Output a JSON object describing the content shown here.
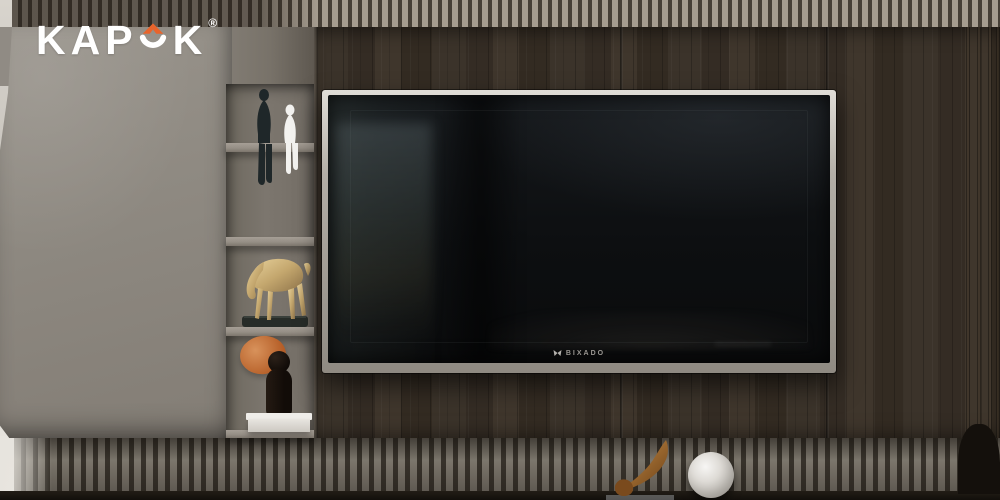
{
  "brand": {
    "full_name": "KAPOK",
    "name_prefix": "KAP",
    "name_suffix": "K",
    "registered_mark": "®",
    "accent_color": "#E8642C",
    "text_color": "#FFFFFF"
  },
  "tv": {
    "brand_label": "BIXADO",
    "logo_icon": "butterfly-icon",
    "frame_color": "#B9B4AC",
    "screen_color": "#0D0F11"
  },
  "palette": {
    "wood_dark": "#372F26",
    "cabinet_gray": "#8E8981",
    "niche_gray": "#76716A",
    "slat_light": "#A59C8F",
    "slat_gap": "#3E3931",
    "floor": "#16120E",
    "shelf_board": "#9E978E"
  },
  "decor": {
    "shelf_items": [
      {
        "name": "sitting-figurine-black",
        "color": "#1F2729"
      },
      {
        "name": "sitting-figurine-white",
        "color": "#F3F2EF"
      },
      {
        "name": "horse-sculpture-gold",
        "color": "#C4A76E",
        "base_color": "#272C28"
      },
      {
        "name": "bubble-figurine-black",
        "color": "#17110E",
        "bubble_color": "#B65F28",
        "base_color": "#EFEDE9"
      }
    ],
    "floor_items": [
      {
        "name": "bronze-abstract-sculpture",
        "color": "#9C6527"
      },
      {
        "name": "glass-sphere-lamp",
        "color": "#DEDBD6"
      },
      {
        "name": "dark-planter-silhouette",
        "color": "#14100C"
      }
    ]
  }
}
